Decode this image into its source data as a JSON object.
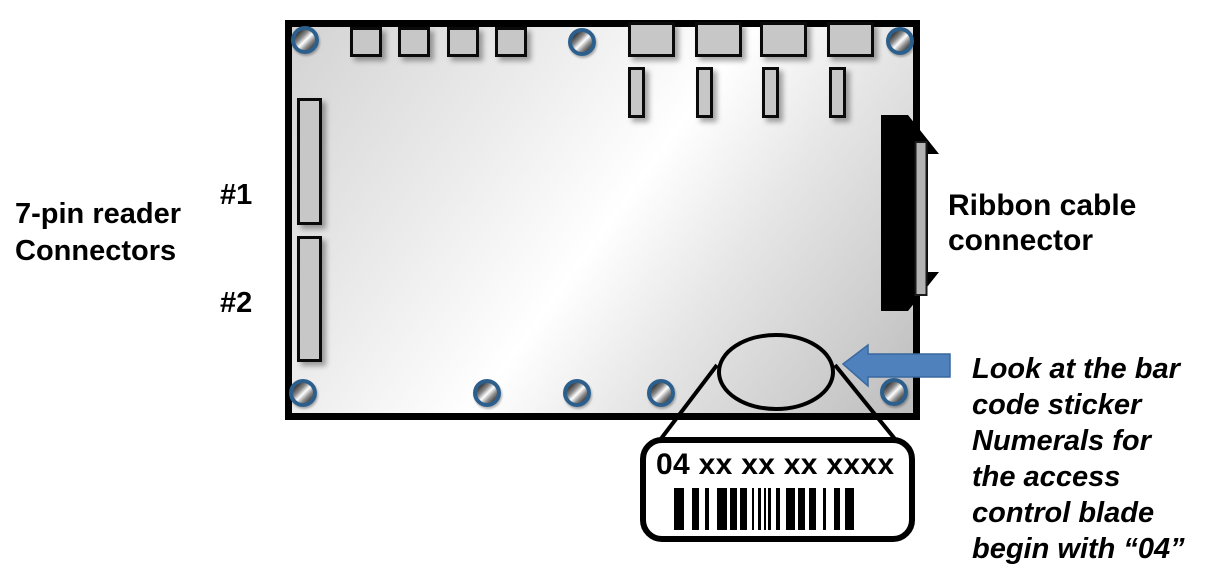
{
  "labels": {
    "reader_connectors": "7-pin reader\nConnectors",
    "connector_1": "#1",
    "connector_2": "#2",
    "ribbon_connector": "Ribbon cable\nconnector",
    "barcode_note": "Look at the bar\ncode sticker\nNumerals for\nthe access\ncontrol blade\nbegin with “04”"
  },
  "callout": {
    "barcode_number": "04 xx xx xx xxxx",
    "barcode_pattern": [
      [
        10,
        8
      ],
      [
        7,
        6
      ],
      [
        4,
        8
      ],
      [
        10,
        3
      ],
      [
        7,
        3
      ],
      [
        7,
        5
      ],
      [
        2,
        4
      ],
      [
        3,
        3
      ],
      [
        2,
        2
      ],
      [
        3,
        5
      ],
      [
        4,
        6
      ],
      [
        9,
        3
      ],
      [
        7,
        4
      ],
      [
        7,
        7
      ],
      [
        3,
        8
      ],
      [
        6,
        5
      ],
      [
        9,
        0
      ]
    ]
  },
  "icons": {
    "screw": "screw-icon",
    "arrow": "arrow-left-icon"
  },
  "colors": {
    "arrow_blue": "#4f81bd",
    "arrow_edge": "#3a699f",
    "screw_ring": "#2d5f8d",
    "connector_fill": "#c7c7c7",
    "board_outline": "#000000"
  }
}
